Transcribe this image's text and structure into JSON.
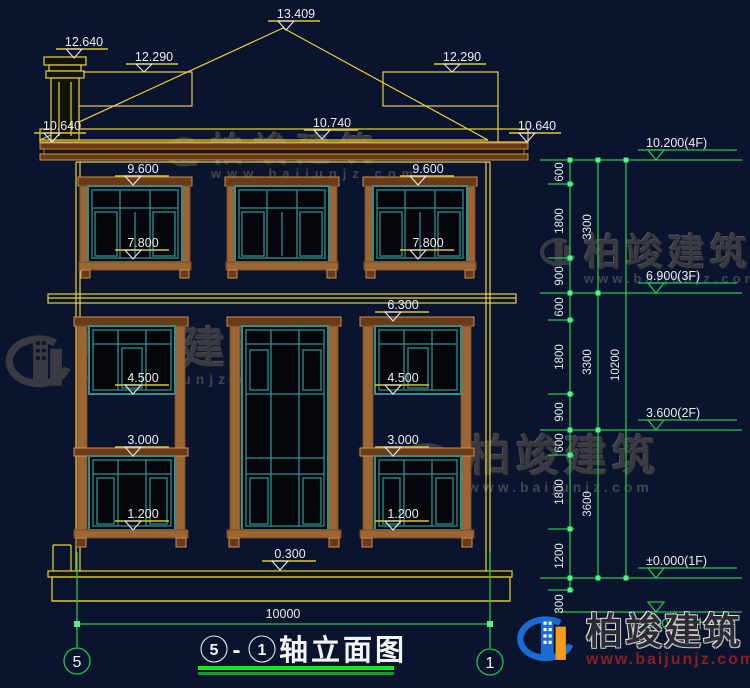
{
  "page_bg": "#0a142e",
  "colors": {
    "cad_yellow": "#e8d23c",
    "dim_green": "#27c24f",
    "frame_teal": "#2f8f8f",
    "wood_brown": "#9c6535",
    "watermark_gray": "#3d3d45",
    "text_white": "#ededed"
  },
  "watermark": {
    "brand": "柏竣建筑",
    "site": "www.baijunjz.com"
  },
  "brand": {
    "name": "柏竣建筑",
    "site": "www.baijunjz.com"
  },
  "title": {
    "axis_left": "5",
    "dash": "-",
    "axis_right": "1",
    "text": "轴立面图"
  },
  "axis_bubbles": {
    "left": "5",
    "right": "1"
  },
  "elevation_labels": {
    "peak": "13.409",
    "chimney": "12.640",
    "roof_left": "12.290",
    "roof_right": "12.290",
    "eave_left": "10.640",
    "eave_mid": "10.740",
    "eave_right": "10.640",
    "w3_top_left": "9.600",
    "w3_top_right": "9.600",
    "w3_sill_left": "7.800",
    "w3_sill_right": "7.800",
    "w2_top": "6.300",
    "w2_sill_left": "4.500",
    "w2_sill_right": "4.500",
    "w1_top_left": "3.000",
    "w1_top_right": "3.000",
    "w1_sill_left": "1.200",
    "w1_sill_right": "1.200",
    "plinth": "0.300"
  },
  "story_marks": [
    "10.200(4F)",
    "6.900(3F)",
    "3.600(2F)",
    "±0.000(1F)",
    "-0.300(室外地面)"
  ],
  "dims": {
    "col1": [
      "600",
      "1800",
      "900",
      "600",
      "1800",
      "900",
      "600",
      "1800",
      "1200",
      "300"
    ],
    "col2": [
      "3300",
      "3300",
      "3600"
    ],
    "total_height": "10200",
    "total_width": "10000"
  }
}
